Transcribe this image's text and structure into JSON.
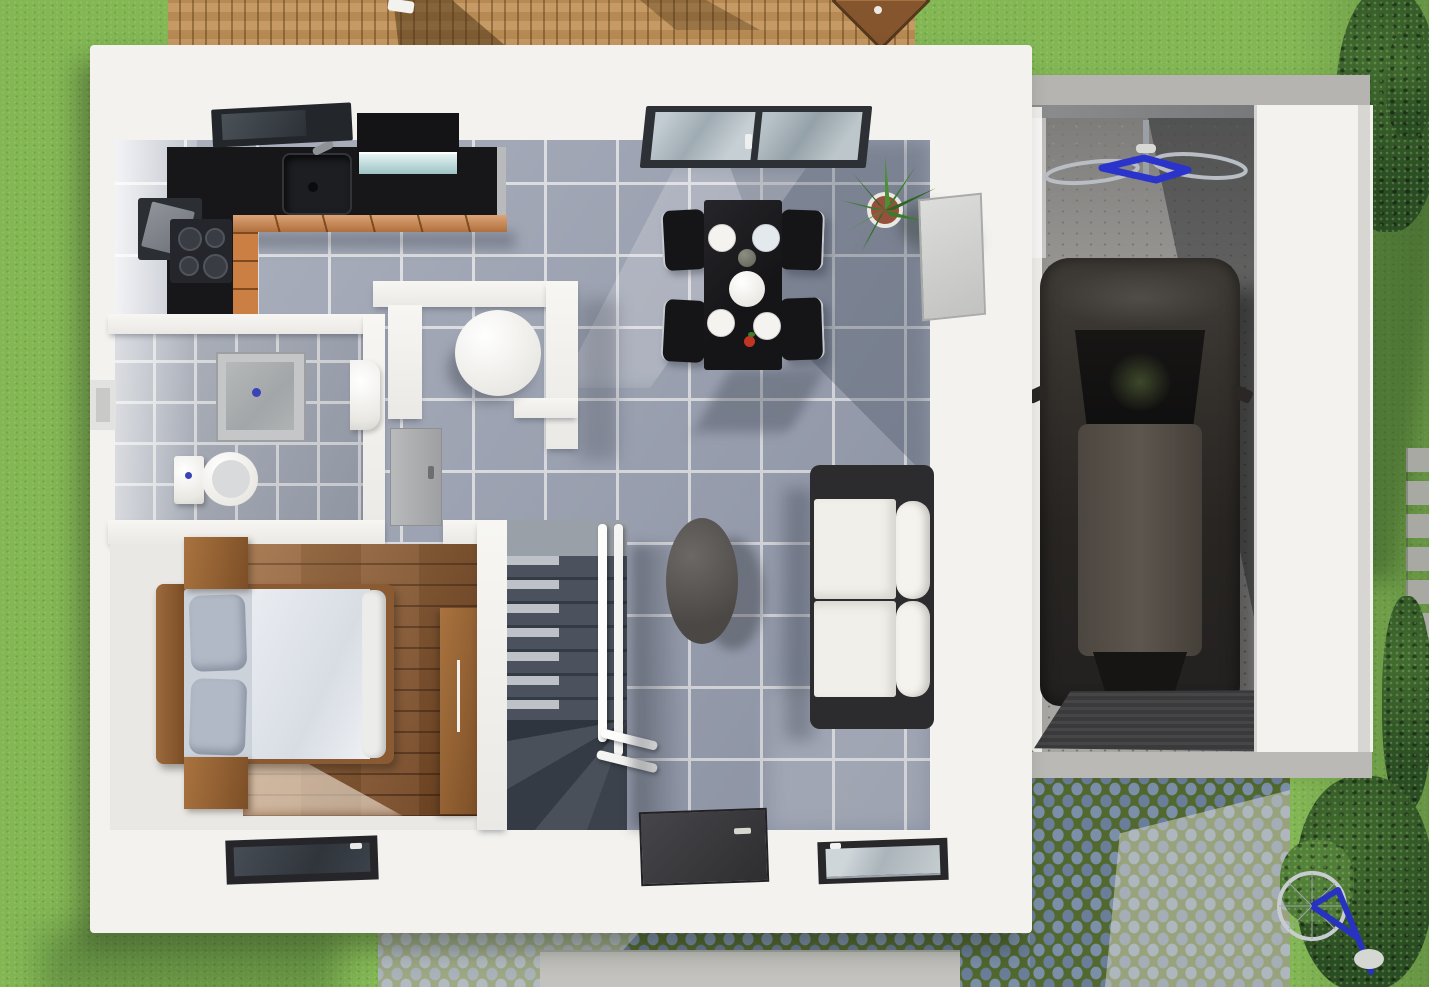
{
  "meta": {
    "title": "3D top-down architectural render — ground floor of a house with attached garage, deck, driveway and garden",
    "render_type": "photorealistic floor-plan render",
    "visible_text": "none"
  },
  "palette": {
    "lawn_green": "#83B754",
    "deck_wood": "#C29258",
    "house_wall_white": "#F3F2EF",
    "tile_floor_gray": "#9AA1B1",
    "bathroom_tile": "#9BA1AD",
    "bedroom_wood": "#82512A",
    "kitchen_counter_black": "#17171A",
    "kitchen_cabinet_orange": "#D08448",
    "stair_dark_gray": "#3F4650",
    "handrail_white": "#FFFFFF",
    "sofa_cushion_white": "#F1EFE9",
    "sofa_frame_black": "#2C2B2E",
    "dining_set_black": "#1B1B1E",
    "car_body_dark": "#2B2824",
    "car_roof_gray": "#574F47",
    "garage_concrete": "#A7A6A3",
    "cobblestone_blue": "#7C8FA9",
    "moss_joint_green": "#51682F",
    "bicycle_blue": "#2733C9",
    "plant_green": "#3C7A2C",
    "plant_pot_terracotta": "#96503C",
    "shower_drain_blue": "#3B43B8",
    "door_dark": "#3A3A3D"
  },
  "scene": {
    "site": {
      "lawn": {
        "name": "lawn",
        "coverage": "surrounds house on all sides"
      },
      "deck": {
        "name": "wooden-deck",
        "position": "top edge behind house",
        "objects": [
          {
            "name": "parasol",
            "shape": "diamond-top"
          },
          {
            "name": "furniture-shadows"
          },
          {
            "name": "white-deck-chair"
          }
        ]
      },
      "driveway": {
        "name": "cobblestone-driveway",
        "material": "cobblestone with moss joints",
        "position": "bottom-right, in front of garage"
      },
      "walkway": {
        "name": "concrete-pad",
        "position": "bottom center below entrance"
      },
      "garden_path": {
        "name": "stepping-stone-path",
        "position": "right edge"
      },
      "vegetation": [
        {
          "name": "tree-canopy-top-right"
        },
        {
          "name": "shrubs-right-edge"
        },
        {
          "name": "bushes-bottom-right"
        },
        {
          "name": "light-shrub-near-bicycle"
        }
      ],
      "bicycle_outdoor": {
        "name": "leaning-bicycle",
        "color": "#2733C9",
        "position": "bottom-right on grass"
      }
    },
    "house": {
      "kitchen": {
        "position": "top-left",
        "objects": [
          {
            "name": "l-shaped-black-counter"
          },
          {
            "name": "sink",
            "count": 1
          },
          {
            "name": "faucet"
          },
          {
            "name": "cooktop",
            "burners": 4
          },
          {
            "name": "oven-open-door"
          },
          {
            "name": "range-hood-glass"
          },
          {
            "name": "tilt-open-window"
          },
          {
            "name": "orange-cabinet-fronts"
          }
        ]
      },
      "dining_area": {
        "position": "top-center",
        "objects": [
          {
            "name": "black-dining-table"
          },
          {
            "name": "dining-chair",
            "count": 4
          },
          {
            "name": "plate",
            "count": 4
          },
          {
            "name": "serving-plate",
            "count": 1
          },
          {
            "name": "vase"
          },
          {
            "name": "tomato-sprig"
          },
          {
            "name": "patio-glass-door"
          },
          {
            "name": "potted-aloe-plant"
          },
          {
            "name": "leaning-wall-picture"
          }
        ]
      },
      "living_area": {
        "position": "right",
        "objects": [
          {
            "name": "sofa-white-black",
            "seats": 2
          },
          {
            "name": "oval-coffee-table"
          },
          {
            "name": "south-window"
          }
        ]
      },
      "bathroom": {
        "position": "left-middle",
        "objects": [
          {
            "name": "shower-tray",
            "drain": "blue"
          },
          {
            "name": "toilet"
          },
          {
            "name": "washbasin"
          },
          {
            "name": "west-wall-window"
          }
        ]
      },
      "wc_niche": {
        "position": "center",
        "objects": [
          {
            "name": "round-white-table"
          }
        ]
      },
      "hallway": {
        "position": "center-left",
        "objects": [
          {
            "name": "open-gray-door"
          }
        ]
      },
      "bedroom": {
        "position": "bottom-left",
        "floor": "dark wood planks",
        "objects": [
          {
            "name": "double-bed"
          },
          {
            "name": "pillow",
            "count": 2
          },
          {
            "name": "nightstand",
            "count": 2
          },
          {
            "name": "wardrobe"
          },
          {
            "name": "south-window"
          }
        ]
      },
      "staircase": {
        "position": "center-bottom",
        "objects": [
          {
            "name": "winder-stairs",
            "color": "#3F4650"
          },
          {
            "name": "white-handrail"
          }
        ]
      },
      "entrance": {
        "position": "bottom-center",
        "objects": [
          {
            "name": "front-door",
            "color": "#3A3A3D",
            "handle": true
          }
        ]
      }
    },
    "garage": {
      "position": "right, attached volume",
      "objects": [
        {
          "name": "car",
          "color": "dark gray-brown",
          "orientation": "nose to back wall"
        },
        {
          "name": "hanging-bicycle",
          "color": "#2733C9",
          "mount": "back wall"
        },
        {
          "name": "ribbed-entrance-mat"
        },
        {
          "name": "concrete-floor"
        },
        {
          "name": "concrete-apron"
        }
      ]
    }
  }
}
